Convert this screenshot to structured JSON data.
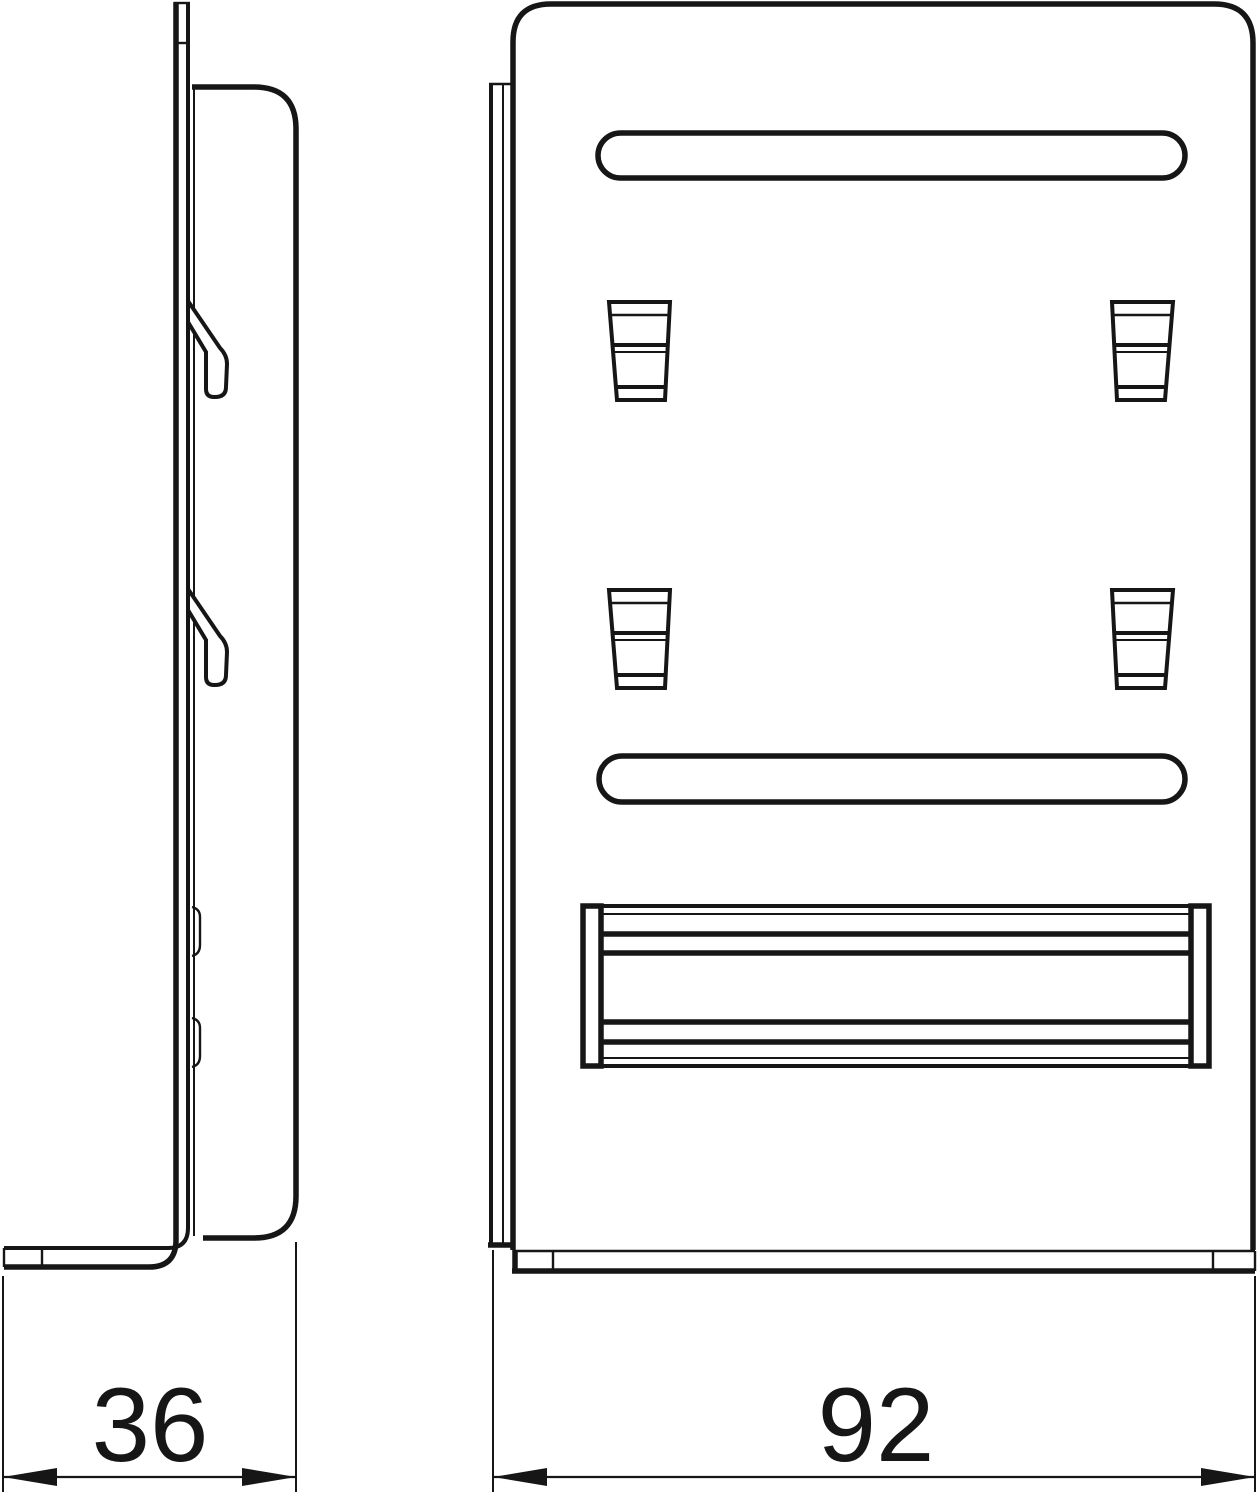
{
  "drawing": {
    "line_color": "#161616",
    "background_color": "#ffffff",
    "dimensions": [
      {
        "view": "side",
        "axis": "horizontal",
        "value": "36"
      },
      {
        "view": "front",
        "axis": "horizontal",
        "value": "92"
      }
    ]
  }
}
